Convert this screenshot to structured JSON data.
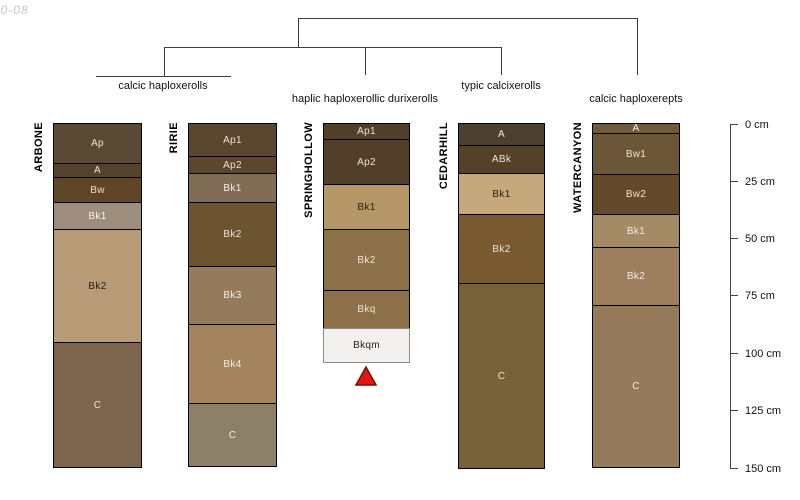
{
  "figure_note": "10-08",
  "chart_data": {
    "type": "soil-profile-dendrogram",
    "title": "",
    "depth_axis": {
      "unit": "cm",
      "axis_x_px": 730,
      "tick_len_px": 8,
      "label_x_px": 745,
      "ticks": [
        {
          "label": "0 cm",
          "y_px": 124
        },
        {
          "label": "25 cm",
          "y_px": 181
        },
        {
          "label": "50 cm",
          "y_px": 238
        },
        {
          "label": "75 cm",
          "y_px": 295
        },
        {
          "label": "100 cm",
          "y_px": 353
        },
        {
          "label": "125 cm",
          "y_px": 410
        },
        {
          "label": "150 cm",
          "y_px": 468
        }
      ]
    },
    "dendrogram": {
      "segments": [
        {
          "x1": 298,
          "y1": 18,
          "x2": 637,
          "y2": 18
        },
        {
          "x1": 298,
          "y1": 18,
          "x2": 298,
          "y2": 47
        },
        {
          "x1": 637,
          "y1": 18,
          "x2": 637,
          "y2": 75
        },
        {
          "x1": 164,
          "y1": 47,
          "x2": 501,
          "y2": 47
        },
        {
          "x1": 164,
          "y1": 47,
          "x2": 164,
          "y2": 77
        },
        {
          "x1": 96,
          "y1": 76,
          "x2": 231,
          "y2": 76
        },
        {
          "x1": 365,
          "y1": 47,
          "x2": 365,
          "y2": 75
        },
        {
          "x1": 501,
          "y1": 47,
          "x2": 501,
          "y2": 75
        }
      ],
      "labels": [
        {
          "text": "calcic haploxerolls",
          "x_px": 163,
          "y_px": 80
        },
        {
          "text": "haplic haploxerollic durixerolls",
          "x_px": 365,
          "y_px": 93
        },
        {
          "text": "typic calcixerolls",
          "x_px": 501,
          "y_px": 80
        },
        {
          "text": "calcic haploxerepts",
          "x_px": 636,
          "y_px": 93
        }
      ]
    },
    "profiles": [
      {
        "name": "ARBONE",
        "x_px": 53,
        "width_px": 89,
        "top_px": 123,
        "horizons": [
          {
            "label": "Ap",
            "height_px": 41,
            "color": "#5a4935",
            "label_color": "#ede3d0"
          },
          {
            "label": "A",
            "height_px": 15,
            "color": "#52422e",
            "label_color": "#ede3d0"
          },
          {
            "label": "Bw",
            "height_px": 26,
            "color": "#5e4626",
            "label_color": "#ede3d0"
          },
          {
            "label": "Bk1",
            "height_px": 28,
            "color": "#9d8d7d",
            "label_color": "#f7f2ea"
          },
          {
            "label": "Bk2",
            "height_px": 114,
            "color": "#b79b76",
            "label_color": "#2b2113"
          },
          {
            "label": "C",
            "height_px": 126,
            "color": "#7d644c",
            "label_color": "#ede3d0"
          }
        ]
      },
      {
        "name": "RIRIE",
        "x_px": 188,
        "width_px": 89,
        "top_px": 123,
        "horizons": [
          {
            "label": "Ap1",
            "height_px": 34,
            "color": "#5b4730",
            "label_color": "#ede3d0"
          },
          {
            "label": "Ap2",
            "height_px": 18,
            "color": "#5d462b",
            "label_color": "#ede3d0"
          },
          {
            "label": "Bk1",
            "height_px": 30,
            "color": "#806d56",
            "label_color": "#f3ede2"
          },
          {
            "label": "Bk2",
            "height_px": 65,
            "color": "#6d5431",
            "label_color": "#ede3d0"
          },
          {
            "label": "Bk3",
            "height_px": 59,
            "color": "#947b5b",
            "label_color": "#f3ede2"
          },
          {
            "label": "Bk4",
            "height_px": 80,
            "color": "#a4845f",
            "label_color": "#f3ede2"
          },
          {
            "label": "C",
            "height_px": 64,
            "color": "#8d8068",
            "label_color": "#f3ede2"
          }
        ]
      },
      {
        "name": "SPRINGHOLLOW",
        "x_px": 323,
        "width_px": 87,
        "top_px": 123,
        "horizons": [
          {
            "label": "Ap1",
            "height_px": 17,
            "color": "#523f29",
            "label_color": "#ede3d0"
          },
          {
            "label": "Ap2",
            "height_px": 46,
            "color": "#523f29",
            "label_color": "#ede3d0"
          },
          {
            "label": "Bk1",
            "height_px": 46,
            "color": "#b59768",
            "label_color": "#2b2113"
          },
          {
            "label": "Bk2",
            "height_px": 62,
            "color": "#8c704a",
            "label_color": "#ede3d0"
          },
          {
            "label": "Bkq",
            "height_px": 39,
            "color": "#8c704a",
            "label_color": "#ede3d0"
          },
          {
            "label": "Bkqm",
            "height_px": 35,
            "color": "#f2f1ef",
            "label_color": "#222222",
            "border_color": "#8a8a8a"
          }
        ]
      },
      {
        "name": "CEDARHILL",
        "x_px": 458,
        "width_px": 87,
        "top_px": 123,
        "horizons": [
          {
            "label": "A",
            "height_px": 23,
            "color": "#4e4030",
            "label_color": "#ede3d0"
          },
          {
            "label": "ABk",
            "height_px": 29,
            "color": "#544128",
            "label_color": "#ede3d0"
          },
          {
            "label": "Bk1",
            "height_px": 42,
            "color": "#c6a87d",
            "label_color": "#2b2113"
          },
          {
            "label": "Bk2",
            "height_px": 70,
            "color": "#7a5a30",
            "label_color": "#ede3d0"
          },
          {
            "label": "C",
            "height_px": 186,
            "color": "#776139",
            "label_color": "#ede3d0"
          }
        ]
      },
      {
        "name": "WATERCANYON",
        "x_px": 592,
        "width_px": 88,
        "top_px": 123,
        "horizons": [
          {
            "label": "A",
            "height_px": 11,
            "color": "#6f5a3b",
            "label_color": "#f3ede2"
          },
          {
            "label": "Bw1",
            "height_px": 42,
            "color": "#6b5637",
            "label_color": "#ede3d0"
          },
          {
            "label": "Bw2",
            "height_px": 41,
            "color": "#64492a",
            "label_color": "#ede3d0"
          },
          {
            "label": "Bk1",
            "height_px": 34,
            "color": "#a58a66",
            "label_color": "#f3ede2"
          },
          {
            "label": "Bk2",
            "height_px": 59,
            "color": "#9d7f5f",
            "label_color": "#f3ede2"
          },
          {
            "label": "C",
            "height_px": 163,
            "color": "#957a5b",
            "label_color": "#f3ede2"
          }
        ]
      }
    ],
    "duripan_marker": {
      "x_px": 366,
      "top_px": 367,
      "bottom_px": 385,
      "half_width_px": 10,
      "fill": "#e3170d",
      "stroke": "#7a0c06"
    }
  }
}
